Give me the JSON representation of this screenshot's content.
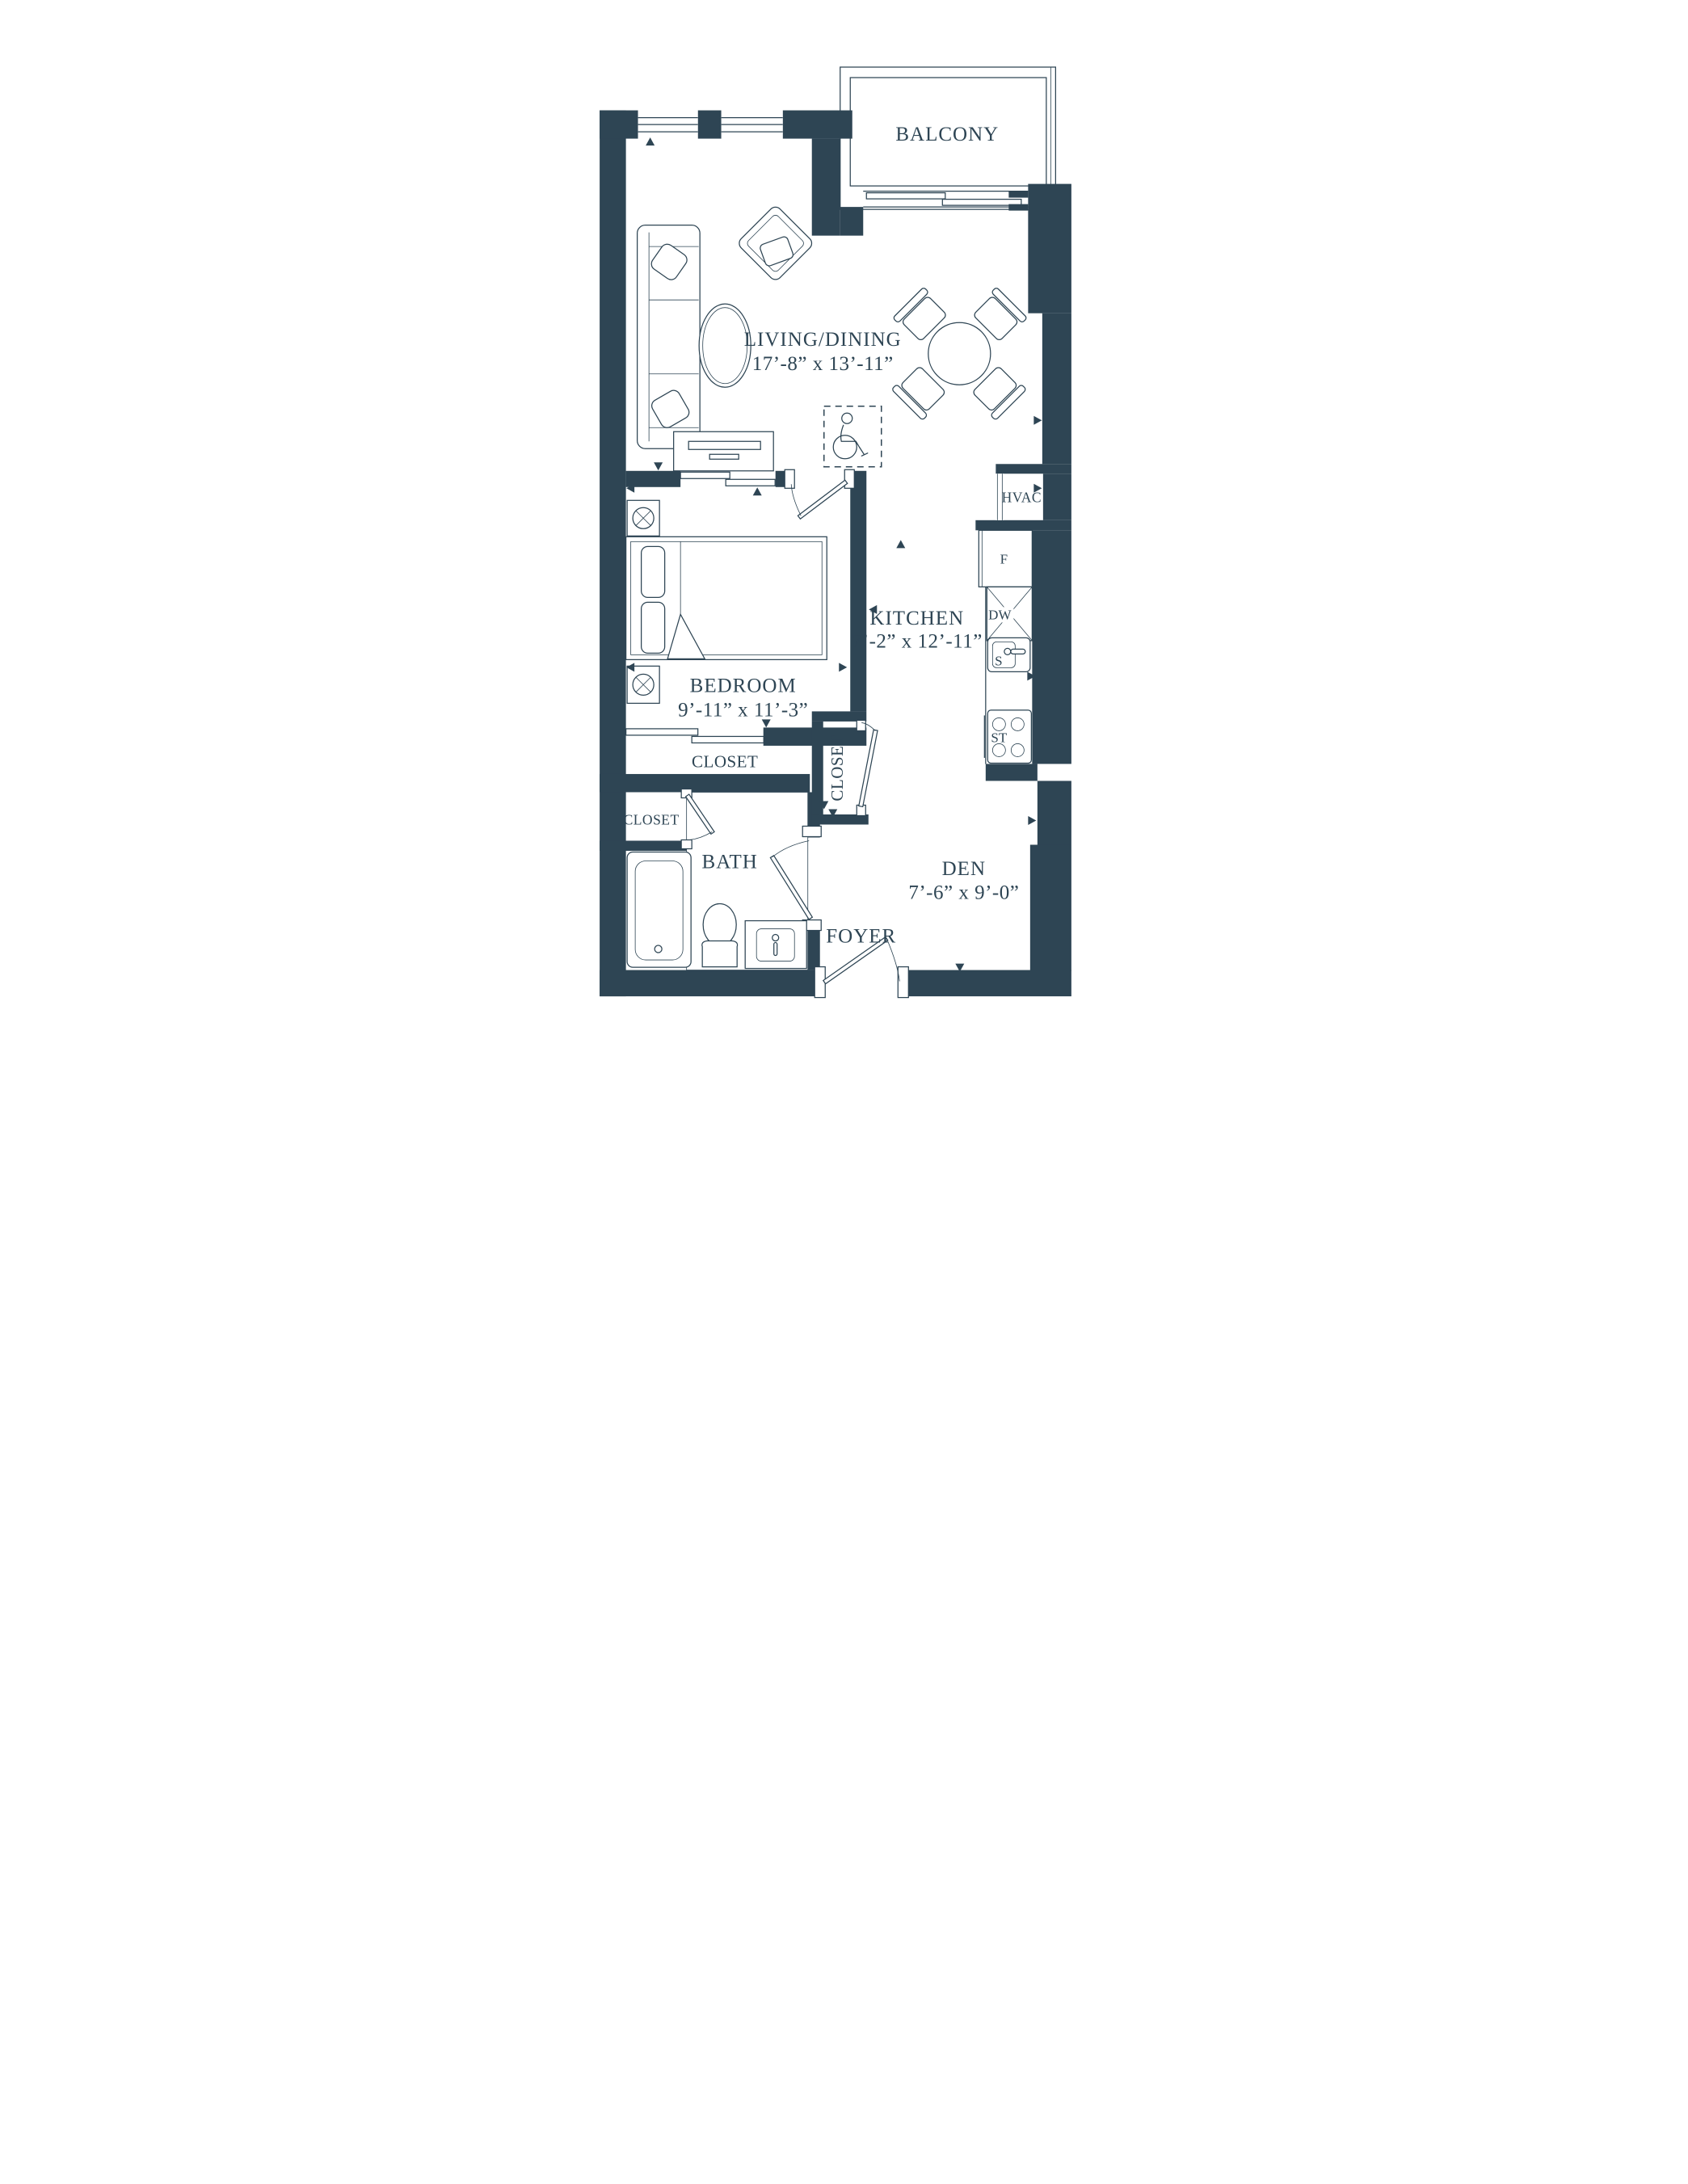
{
  "palette": {
    "ink": "#2e4554",
    "background": "#ffffff"
  },
  "rooms": {
    "balcony": {
      "label": "BALCONY"
    },
    "living": {
      "label": "LIVING/DINING",
      "dims": "17’-8” x 13’-11”"
    },
    "bedroom": {
      "label": "BEDROOM",
      "dims": "9’-11” x 11’-3”"
    },
    "kitchen": {
      "label": "KITCHEN",
      "dims": "7’-2” x 12’-11”"
    },
    "den": {
      "label": "DEN",
      "dims": "7’-6” x 9’-0”"
    },
    "bath": {
      "label": "BATH"
    },
    "foyer": {
      "label": "FOYER"
    },
    "hvac": {
      "label": "HVAC"
    },
    "closet_bedroom": {
      "label": "CLOSET"
    },
    "closet_linen": {
      "label": "CLOSET"
    },
    "closet_foyer": {
      "label": "CLOSET"
    }
  },
  "appliances": {
    "fridge": "F",
    "dishwasher": "DW",
    "sink": "S",
    "stove": "ST"
  }
}
